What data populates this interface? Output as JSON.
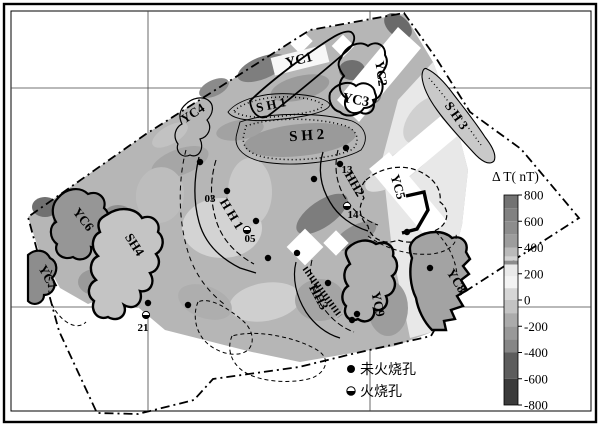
{
  "figure": {
    "type": "magnetic-anomaly-contour-map",
    "colorbar": {
      "title": "Δ T( nT)",
      "unit": "nT",
      "range_min": -800,
      "range_max": 800,
      "ticks": [
        "800",
        "600",
        "400",
        "200",
        "0",
        "-200",
        "-400",
        "-600",
        "-800"
      ],
      "tick_values": [
        800,
        600,
        400,
        200,
        0,
        -200,
        -400,
        -600,
        -800
      ],
      "bands": [
        {
          "from": 800,
          "to": 700,
          "color": "#737373"
        },
        {
          "from": 700,
          "to": 600,
          "color": "#818181"
        },
        {
          "from": 600,
          "to": 500,
          "color": "#8d8d8d"
        },
        {
          "from": 500,
          "to": 400,
          "color": "#9d9d9d"
        },
        {
          "from": 400,
          "to": 330,
          "color": "#bababa"
        },
        {
          "from": 330,
          "to": 300,
          "color": "#d2d2d2"
        },
        {
          "from": 300,
          "to": 270,
          "color": "#8c8c8c"
        },
        {
          "from": 270,
          "to": 180,
          "color": "#eaeaea"
        },
        {
          "from": 180,
          "to": 90,
          "color": "#f3f3f3"
        },
        {
          "from": 90,
          "to": 0,
          "color": "#d6d6d6"
        },
        {
          "from": 0,
          "to": -100,
          "color": "#c3c3c3"
        },
        {
          "from": -100,
          "to": -200,
          "color": "#ababab"
        },
        {
          "from": -200,
          "to": -300,
          "color": "#999999"
        },
        {
          "from": -300,
          "to": -400,
          "color": "#868686"
        },
        {
          "from": -400,
          "to": -600,
          "color": "#5d5d5d"
        },
        {
          "from": -600,
          "to": -800,
          "color": "#3b3b3b"
        }
      ]
    },
    "legend": {
      "items": [
        {
          "symbol": "filled-circle",
          "label": "未火烧孔"
        },
        {
          "symbol": "half-filled-circle",
          "label": "火烧孔"
        }
      ]
    },
    "map": {
      "zones": [
        {
          "id": "sh1",
          "label": "S H 1",
          "x": 272,
          "y": 109,
          "rot": -12,
          "size": 13
        },
        {
          "id": "sh2",
          "label": "S H 2",
          "x": 307,
          "y": 140,
          "rot": -4,
          "size": 15
        },
        {
          "id": "sh3",
          "label": "S H 3",
          "x": 453,
          "y": 118,
          "rot": 55,
          "size": 13
        },
        {
          "id": "sh4",
          "label": "SH4",
          "x": 131,
          "y": 247,
          "rot": 57,
          "size": 13
        },
        {
          "id": "yc1",
          "label": "YC1",
          "x": 300,
          "y": 64,
          "rot": -14,
          "size": 14
        },
        {
          "id": "yc2",
          "label": "YC2",
          "x": 377,
          "y": 74,
          "rot": 82,
          "size": 13
        },
        {
          "id": "yc3",
          "label": "YC3",
          "x": 355,
          "y": 104,
          "rot": 10,
          "size": 14
        },
        {
          "id": "yc4",
          "label": "YC4",
          "x": 195,
          "y": 117,
          "rot": -33,
          "size": 13
        },
        {
          "id": "yc5",
          "label": "YC5",
          "x": 394,
          "y": 188,
          "rot": 74,
          "size": 13
        },
        {
          "id": "yc6",
          "label": "YC6",
          "x": 80,
          "y": 222,
          "rot": 52,
          "size": 13
        },
        {
          "id": "yc7",
          "label": "YC7",
          "x": 44,
          "y": 279,
          "rot": 62,
          "size": 13
        },
        {
          "id": "yc8",
          "label": "YC8",
          "x": 453,
          "y": 283,
          "rot": 58,
          "size": 13
        },
        {
          "id": "yc9",
          "label": "YC9",
          "x": 374,
          "y": 305,
          "rot": 78,
          "size": 13
        },
        {
          "id": "hh1",
          "label": "H H 1",
          "x": 228,
          "y": 216,
          "rot": 59,
          "size": 13
        },
        {
          "id": "hh2",
          "label": "HH2",
          "x": 351,
          "y": 186,
          "rot": 60,
          "size": 13
        },
        {
          "id": "hh3",
          "label": "HH3",
          "x": 315,
          "y": 299,
          "rot": 62,
          "size": 13
        }
      ],
      "hole_numbers": [
        {
          "text": "03",
          "x": 210,
          "y": 202
        },
        {
          "text": "05",
          "x": 250,
          "y": 242
        },
        {
          "text": "13",
          "x": 347,
          "y": 173
        },
        {
          "text": "14",
          "x": 353,
          "y": 218
        },
        {
          "text": "21",
          "x": 143,
          "y": 331
        }
      ],
      "holes": {
        "unburned": [
          [
            200,
            162
          ],
          [
            227,
            191
          ],
          [
            256,
            221
          ],
          [
            297,
            253
          ],
          [
            268,
            258
          ],
          [
            346,
            148
          ],
          [
            340,
            164
          ],
          [
            314,
            179
          ],
          [
            407,
            232
          ],
          [
            328,
            283
          ],
          [
            357,
            314
          ],
          [
            352,
            320
          ],
          [
            430,
            268
          ],
          [
            148,
            303
          ],
          [
            188,
            305
          ]
        ],
        "burned": [
          [
            146,
            315
          ],
          [
            347,
            206
          ],
          [
            247,
            230
          ]
        ]
      }
    }
  }
}
